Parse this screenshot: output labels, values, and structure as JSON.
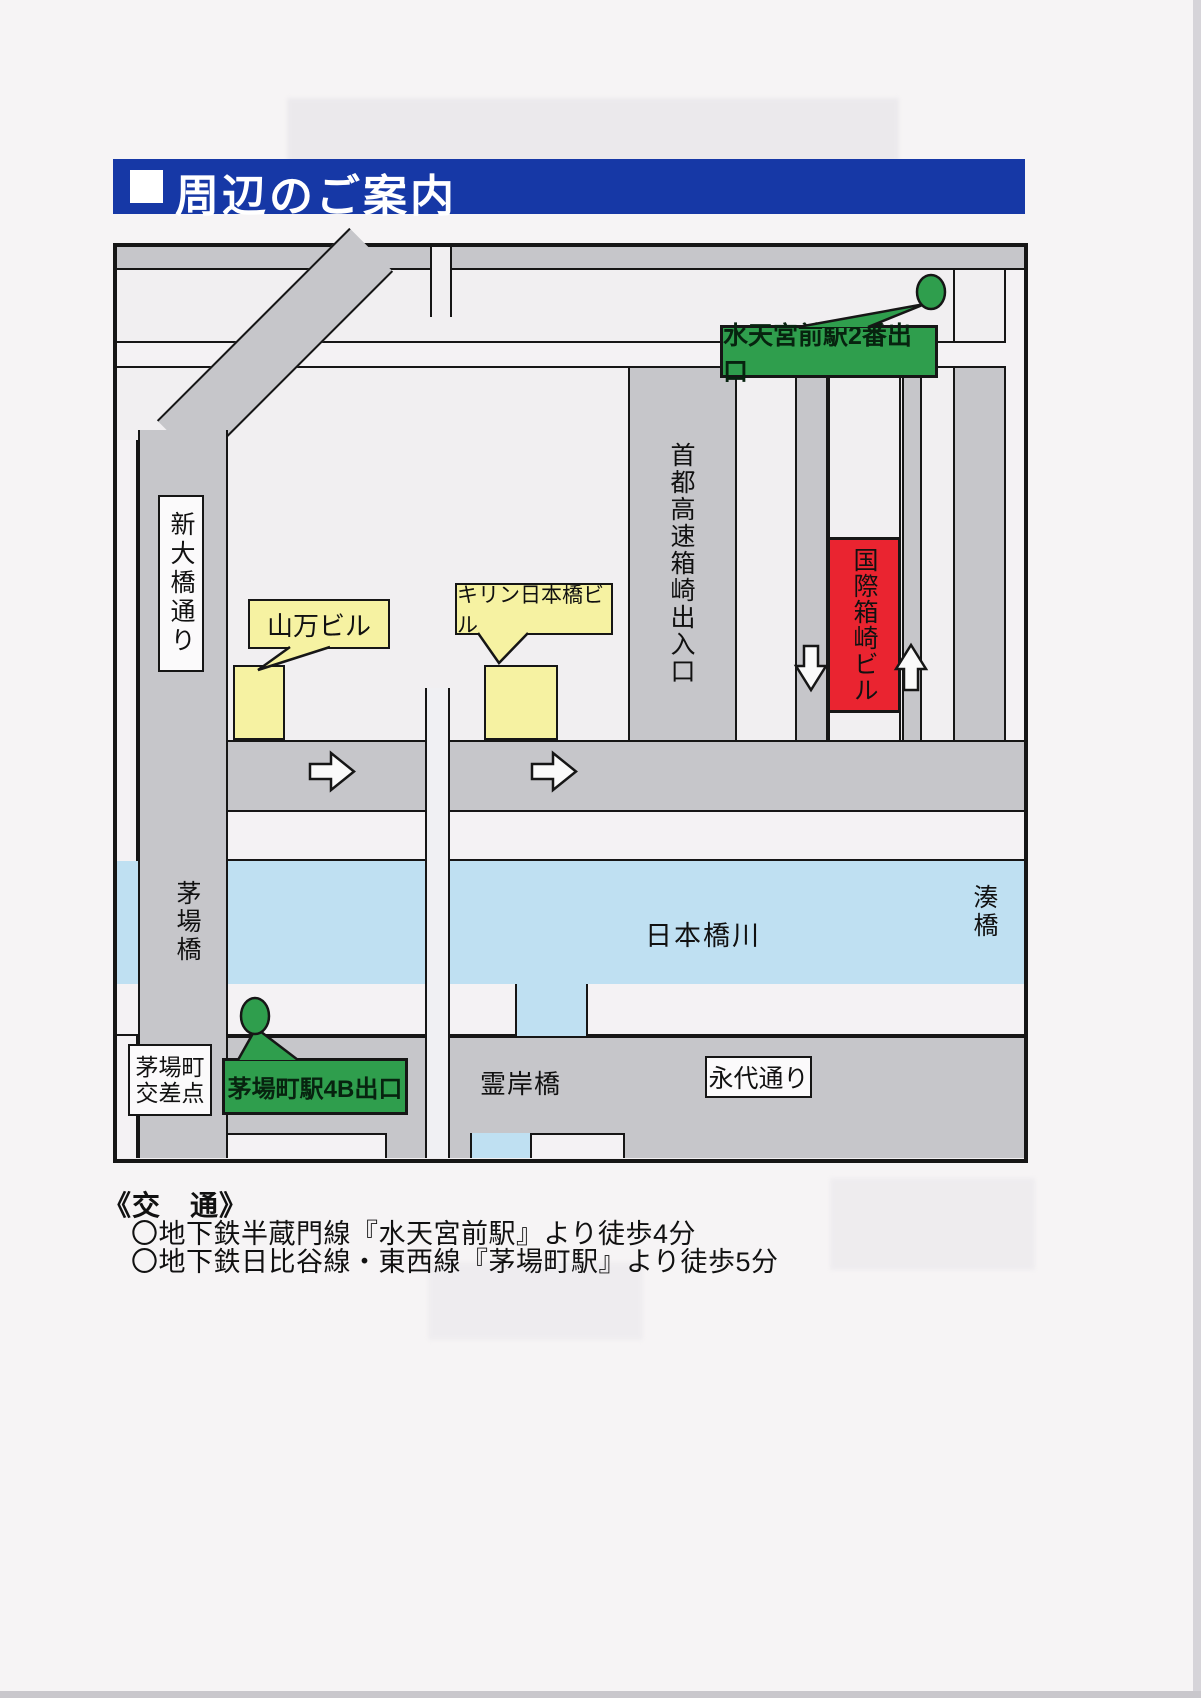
{
  "header": {
    "title": "周辺のご案内"
  },
  "map": {
    "station_exits": [
      {
        "id": "suitengumae",
        "label": "水天宮前駅2番出口"
      },
      {
        "id": "kayabacho",
        "label": "茅場町駅4B出口"
      }
    ],
    "buildings": [
      {
        "id": "yamaman",
        "label": "山万ビル"
      },
      {
        "id": "kirin",
        "label": "キリン日本橋ビル"
      },
      {
        "id": "kokusai_hakozaki",
        "label": "国際箱崎ビル",
        "highlight": true
      }
    ],
    "roads": [
      {
        "id": "shin_ohashi_dori",
        "label": "新大橋通り"
      },
      {
        "id": "shuto_expressway_hakozaki_exit",
        "label": "首都高速箱崎出入口"
      },
      {
        "id": "eitai_dori",
        "label": "永代通り"
      }
    ],
    "bridges": [
      {
        "id": "kayaba_bashi",
        "label": "茅場橋"
      },
      {
        "id": "minato_bashi",
        "label": "湊橋"
      },
      {
        "id": "reigan_bashi",
        "label": "霊岸橋"
      }
    ],
    "river": {
      "label": "日本橋川"
    },
    "intersection": {
      "label": "茅場町交差点",
      "line1": "茅場町",
      "line2": "交差点"
    },
    "icons": [
      {
        "name": "station-exit-marker-icon",
        "shape": "green-oval"
      },
      {
        "name": "direction-arrow-icon",
        "shape": "white-outlined-arrow"
      }
    ]
  },
  "access": {
    "heading": "《交　通》",
    "items": [
      "〇地下鉄半蔵門線『水天宮前駅』より徒歩4分",
      "〇地下鉄日比谷線・東西線『茅場町駅』より徒歩5分"
    ]
  },
  "colors": {
    "header_blue": "#1638a6",
    "road_gray": "#c6c6ca",
    "river_blue": "#bfe0f2",
    "exit_green": "#2f9e4d",
    "building_yellow": "#f6f2a2",
    "highlight_red": "#ea2430"
  }
}
